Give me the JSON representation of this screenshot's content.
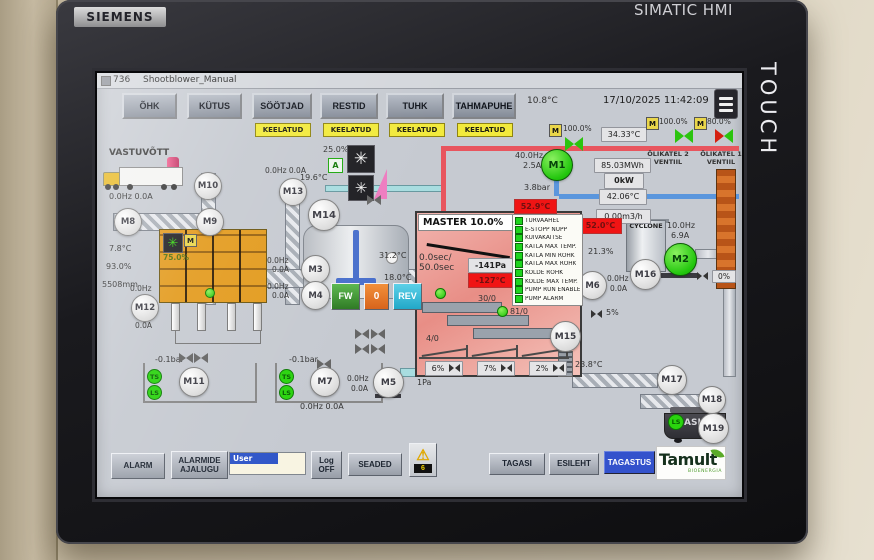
{
  "device": {
    "brand": "SIEMENS",
    "product": "SIMATIC HMI",
    "bezel_label": "TOUCH"
  },
  "icons": {
    "fan": "✳",
    "cloud": "☁",
    "warning": "⚠"
  },
  "header": {
    "page_id": "736",
    "title": "Shootblower_Manual",
    "outdoor_temp": "10.8°C",
    "datetime": "17/10/2025 11:42:09",
    "nav": [
      {
        "label": "ÕHK"
      },
      {
        "label": "KÜTUS"
      },
      {
        "label": "SÖÖTJAD"
      },
      {
        "label": "RESTID"
      },
      {
        "label": "TUHK"
      },
      {
        "label": "TAHMAPUHE"
      }
    ],
    "disabled_tag": "KEELATUD"
  },
  "reception": {
    "title": "VASTUVÕTT",
    "truck_value": "0.0Hz 0.0A",
    "m10": "M10",
    "m8": "M8",
    "m9": "M9",
    "m13": "M13",
    "m13_value": "0.0Hz 0.0A",
    "silo_badge": "M",
    "silo_level": "75.0%",
    "temp": "7.8°C",
    "moisture": "93.0%",
    "level": "5508mm",
    "m12": "M12",
    "m12_hz": "0.0Hz",
    "m12_a": "0.0A"
  },
  "feeders": {
    "vacuum_left": "-0.1bar",
    "vacuum_right": "-0.1bar",
    "ts": "TS",
    "ls": "LS",
    "m11": "M11",
    "m7": "M7",
    "m7_value": "0.0Hz 0.0A",
    "m5": "M5",
    "m5_hz": "0.0Hz",
    "m5_a": "0.0A",
    "pipe_pressure": "1Pa"
  },
  "mixer": {
    "fan_pct": "25.0%",
    "auto_badge": "A",
    "fan_temp": "19.6°C",
    "m14": "M14",
    "m3": "M3",
    "m3_hz": "0.0Hz",
    "m3_a": "0.0A",
    "m4": "M4",
    "m4_hz": "0.0Hz",
    "m4_a": "0.0A",
    "temp1": "31.2°C",
    "temp2": "18.0°C",
    "fw": "FW",
    "stop": "0",
    "rev": "REV"
  },
  "master": {
    "title": "MASTER 10.0%",
    "cycle": "0.0sec/",
    "cycle2": "50.0sec",
    "pressure": "-141Pa",
    "temp_alarm": "-127°C",
    "counter1": "30/0",
    "counter2": "81/0",
    "counter3": "4/0",
    "damper1": "6%",
    "damper2": "7%",
    "damper3": "2%",
    "status_items": [
      "TURVAAHEL",
      "E-STOPP NUPP",
      "KUIVAKAITSE",
      "KATLA MAX TEMP.",
      "KATLA MIN RÕHK",
      "KATLA MAX RÕHK",
      "KOLDE RÕHK",
      "KOLDE MAX TEMP.",
      "PUMP RUN ENABLE",
      "PUMP ALARM"
    ],
    "m15": "M15",
    "after_temp": "23.8°C"
  },
  "boiler": {
    "valve_badge": "M",
    "valve_pct": "100.0%",
    "supply_temp": "34.33°C",
    "oil2_pct": "100.0%",
    "oil2_line1": "ÕLIKATEL 2",
    "oil2_line2": "VENTIIL",
    "oil1_pct": "80.0%",
    "oil1_line1": "ÕLIKATEL 1",
    "oil1_line2": "VENTIIL",
    "m1": "M1",
    "m1_hz": "40.0Hz",
    "m1_a": "2.5A",
    "pressure": "3.8bar",
    "energy": "85.03MWh",
    "power": "0kW",
    "return_temp": "42.06°C",
    "flow": "0.00m3/h",
    "alarm_temp1": "52.9°C",
    "alarm_temp2": "52.0°C",
    "o2": "21.3%"
  },
  "flue": {
    "cyclone": "CYCLONE",
    "m16": "M16",
    "m2": "M2",
    "m2_hz": "10.0Hz",
    "m2_a": "6.9A",
    "m6": "M6",
    "m6_hz": "0.0Hz",
    "m6_a": "0.0A",
    "damper_5": "5%",
    "damper_0": "0%"
  },
  "ash": {
    "m17": "M17",
    "m18": "M18",
    "m19": "M19",
    "ls": "LS",
    "bin": "ASH"
  },
  "toolbar": {
    "alarm": "ALARM",
    "alarm_hist1": "ALARMIDE",
    "alarm_hist2": "AJALUGU",
    "user": "User",
    "log1": "Log",
    "log2": "OFF",
    "settings": "SEADED",
    "warn_count": "6",
    "back": "TAGASI",
    "home": "ESILEHT",
    "return": "TAGASTUS",
    "brand": "Tamult",
    "brand_sub": "BIOENERGIA"
  },
  "colors": {
    "run_green": "#22c60d",
    "alarm_red": "#f01414",
    "accent_blue": "#3352cc",
    "bunker_orange": "#e39b1e",
    "disabled_yellow": "#f2ea3c"
  }
}
